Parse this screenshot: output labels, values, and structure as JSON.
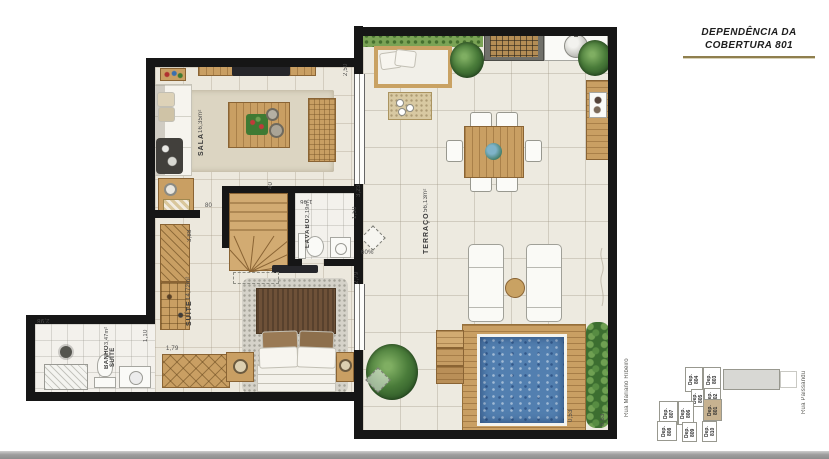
{
  "title": {
    "line1": "DEPENDÊNCIA DA",
    "line2": "COBERTURA 801"
  },
  "rooms": {
    "sala": {
      "name": "SALA",
      "area": "16,35m²"
    },
    "terraco": {
      "name": "TERRAÇO",
      "area": "56,13m²"
    },
    "lavabo": {
      "name": "LAVABO",
      "area": "2,19m²"
    },
    "suite": {
      "name": "SUÍTE",
      "area": "14,72m²"
    },
    "banho": {
      "name": "BANHO SUÍTE",
      "area": "3,47m²"
    }
  },
  "dimensions": {
    "sala_right": "2,50",
    "lavabo_top_right": "3,23",
    "lavabo_width": "1,46",
    "lavabo_right": "1,50",
    "suite_right": "2,79",
    "suite_left": "3,88",
    "suite_dresser": "1,79",
    "banho_top": "2,98",
    "banho_door": "1,10",
    "hall_door": "80",
    "stairs_top": "40",
    "deck_right": "0,53",
    "terrace_bottom_right": "6,63",
    "duct": "60%"
  },
  "key_plan": {
    "units": [
      {
        "label": "Dep. 804"
      },
      {
        "label": "Dep. 803"
      },
      {
        "label": "Dep. 805"
      },
      {
        "label": "Dep. 802"
      },
      {
        "label": "Dep. 807"
      },
      {
        "label": "Dep. 806"
      },
      {
        "label": "Dep. 801",
        "highlighted": true
      },
      {
        "label": "Dep. 808"
      },
      {
        "label": "Dep. 809"
      },
      {
        "label": "Dep. 810"
      }
    ],
    "streets": {
      "left": "Rua Mariano Ribeiro",
      "right": "Rua Paissandu"
    }
  },
  "colors": {
    "wall": "#161616",
    "wood": "#c99f63",
    "pool_water": "#527fb0",
    "plant_green": "#4a7c3a",
    "unit_highlight": "#c7b290",
    "title_underline": "#8f7f4e"
  }
}
